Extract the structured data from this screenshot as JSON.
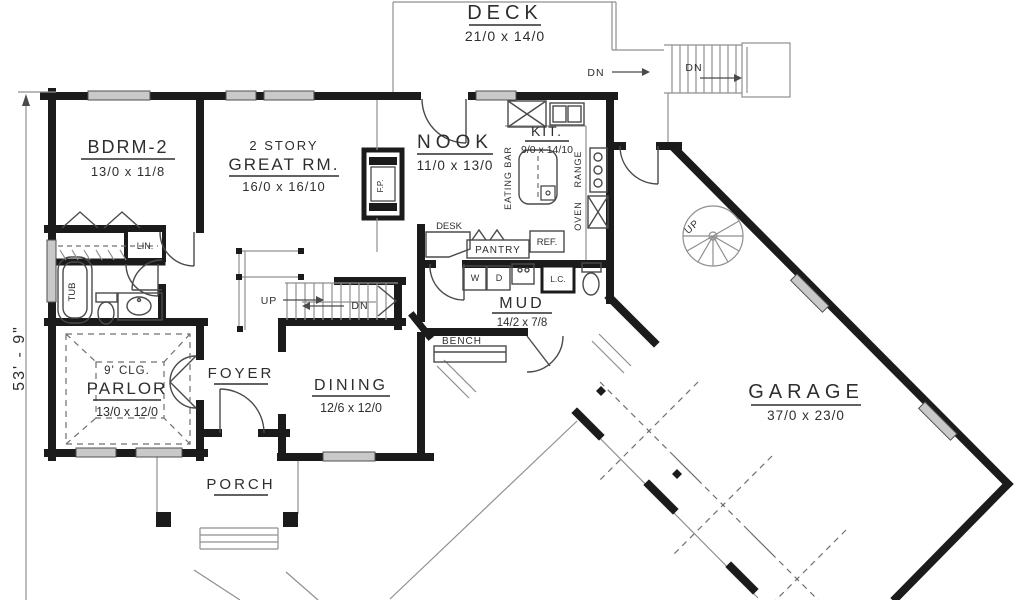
{
  "plan": {
    "side_dimension": "53' - 9\"",
    "rooms": {
      "deck": {
        "name": "DECK",
        "dim": "21/0 x 14/0"
      },
      "bdrm2": {
        "name": "BDRM-2",
        "dim": "13/0 x 11/8"
      },
      "great_rm": {
        "prefix": "2 STORY",
        "name": "GREAT RM.",
        "dim": "16/0 x 16/10"
      },
      "nook": {
        "name": "NOOK",
        "dim": "11/0 x 13/0"
      },
      "kitchen": {
        "name": "KIT.",
        "dim": "9/0 x 14/10"
      },
      "mud": {
        "name": "MUD",
        "dim": "14/2 x 7/8"
      },
      "dining": {
        "name": "DINING",
        "dim": "12/6 x 12/0"
      },
      "parlor": {
        "ceiling": "9' CLG.",
        "name": "PARLOR",
        "dim": "13/0 x 12/0"
      },
      "foyer": {
        "name": "FOYER"
      },
      "porch": {
        "name": "PORCH"
      },
      "garage": {
        "name": "GARAGE",
        "dim": "37/0 x 23/0"
      }
    },
    "labels": {
      "eating_bar": "EATING BAR",
      "range": "RANGE",
      "oven": "OVEN",
      "desk": "DESK",
      "pantry": "PANTRY",
      "ref": "REF.",
      "washer": "W",
      "dryer": "D",
      "linen_cabinet": "L.C.",
      "bench": "BENCH",
      "linen": "LIN.",
      "tub": "TUB",
      "fireplace": "F.P.",
      "up": "UP",
      "down": "DN"
    },
    "colors": {
      "wall": "#1b1b1b",
      "thin_line": "#8f8f8f",
      "window_fill": "#c9c9c9",
      "text": "#2e2e2e"
    }
  }
}
